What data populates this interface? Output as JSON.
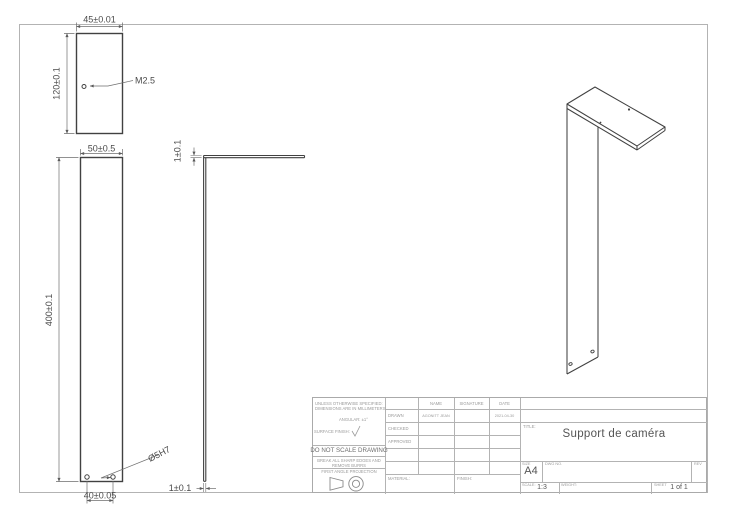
{
  "drawing": {
    "top_view": {
      "width_dim": "45±0.01",
      "height_dim": "120±0.1",
      "thread_callout": "M2.5"
    },
    "front_view": {
      "width_dim": "50±0.5",
      "height_dim": "400±0.1",
      "hole_callout": "Ø5H7",
      "hole_spacing_dim": "40±0.05"
    },
    "side_view": {
      "top_thickness_dim": "1±0.1",
      "bottom_thickness_dim": "1±0.1"
    }
  },
  "title_block": {
    "tolerance_note_1": "UNLESS OTHERWISE SPECIFIED:",
    "tolerance_note_2": "DIMENSIONS ARE IN MILLIMETERS",
    "angular_note": "ANGULAR: ±1°",
    "surface_finish_label": "SURFACE FINISH:",
    "do_not_scale": "DO NOT SCALE DRAWING",
    "deburr_note_1": "BREAK ALL SHARP EDGES AND",
    "deburr_note_2": "REMOVE BURRS",
    "projection_label": "FIRST ANGLE PROJECTION",
    "material_label": "MATERIAL:",
    "finish_label": "FINISH:",
    "columns": {
      "name": "NAME",
      "signature": "SIGNATURE",
      "date": "DATE"
    },
    "rows": [
      {
        "label": "DRAWN",
        "name": "AGONITT JEAN",
        "signature": "",
        "date": "2021-04-30"
      },
      {
        "label": "CHECKED",
        "name": "",
        "signature": "",
        "date": ""
      },
      {
        "label": "APPROVED",
        "name": "",
        "signature": "",
        "date": ""
      }
    ],
    "title_label": "TITLE:",
    "title": "Support de caméra",
    "size_label": "SIZE",
    "size": "A4",
    "dwg_no_label": "DWG NO.",
    "rev_label": "REV",
    "scale_label": "SCALE:",
    "scale": "1:3",
    "weight_label": "WEIGHT:",
    "sheet_label": "SHEET",
    "sheet": "1 of 1"
  }
}
